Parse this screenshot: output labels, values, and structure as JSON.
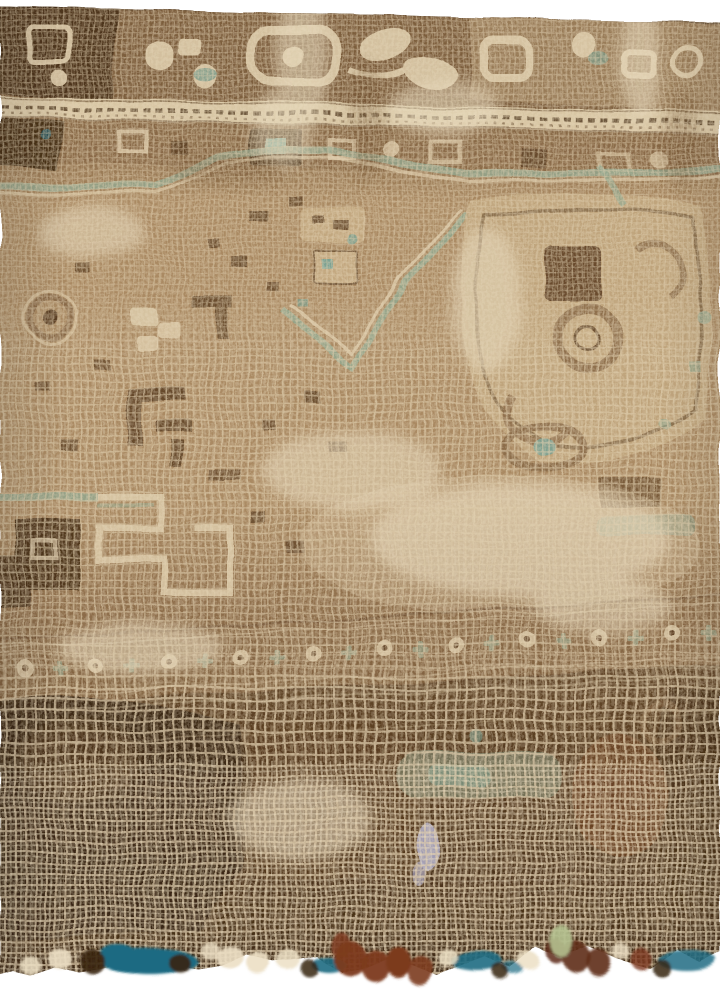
{
  "scene": {
    "type": "photograph",
    "subject": "Distressed antique hand-knotted rug shown in an angled close-up on a white studio background",
    "view": "perspective receding toward the top edge; weave grid grows coarser toward the near, frayed bottom edge",
    "condition": "Heavily worn low pile abraded to the cream cotton foundation; ragged lower edge with loose tufts",
    "regions": {
      "top_border": "Dark brown main border with cream geometric rosette, octagon and hooked-vine motifs",
      "guard_stripe": "Narrow cream guard stripe with a dark meander vine",
      "inner_border": "Secondary brown band with dark box motifs and a small teal center",
      "field": "Faded camel-tan field scattered with dark brown geometric ornaments and sage-green accents",
      "medallion": "Sage-green stepped outlines and a chevron medallion point near the upper center",
      "minor_border": "Worn lower band of alternating cream rosettes and sage crosses",
      "worn_zone": "Dark chocolate lower area worn through to the exposed cream grid foundation",
      "edge": "Frayed bottom edge with teal-blue selvage patches, rust-brown and cream fringe tufts"
    }
  },
  "palette": {
    "background_white": "#ffffff",
    "foundation_cream": "#ddcbaa",
    "foundation_light": "#ecdfc4",
    "field_tan": "#aa8a63",
    "camel_faded": "#c4aa82",
    "border_brown": "#7d5e3e",
    "mid_brown": "#8a6a48",
    "dark_brown": "#4a3219",
    "chocolate": "#5a3d22",
    "espresso": "#362413",
    "shadow_tan": "#6e502f",
    "rust_brown": "#7c3a1e",
    "maroon_tuft": "#5e2c16",
    "chestnut": "#6b4526",
    "sage_green": "#94a68d",
    "teal_green": "#7ba192",
    "teal_blue": "#1e6b82",
    "pale_green": "#b5c190",
    "lavender": "#a9a6c4"
  }
}
